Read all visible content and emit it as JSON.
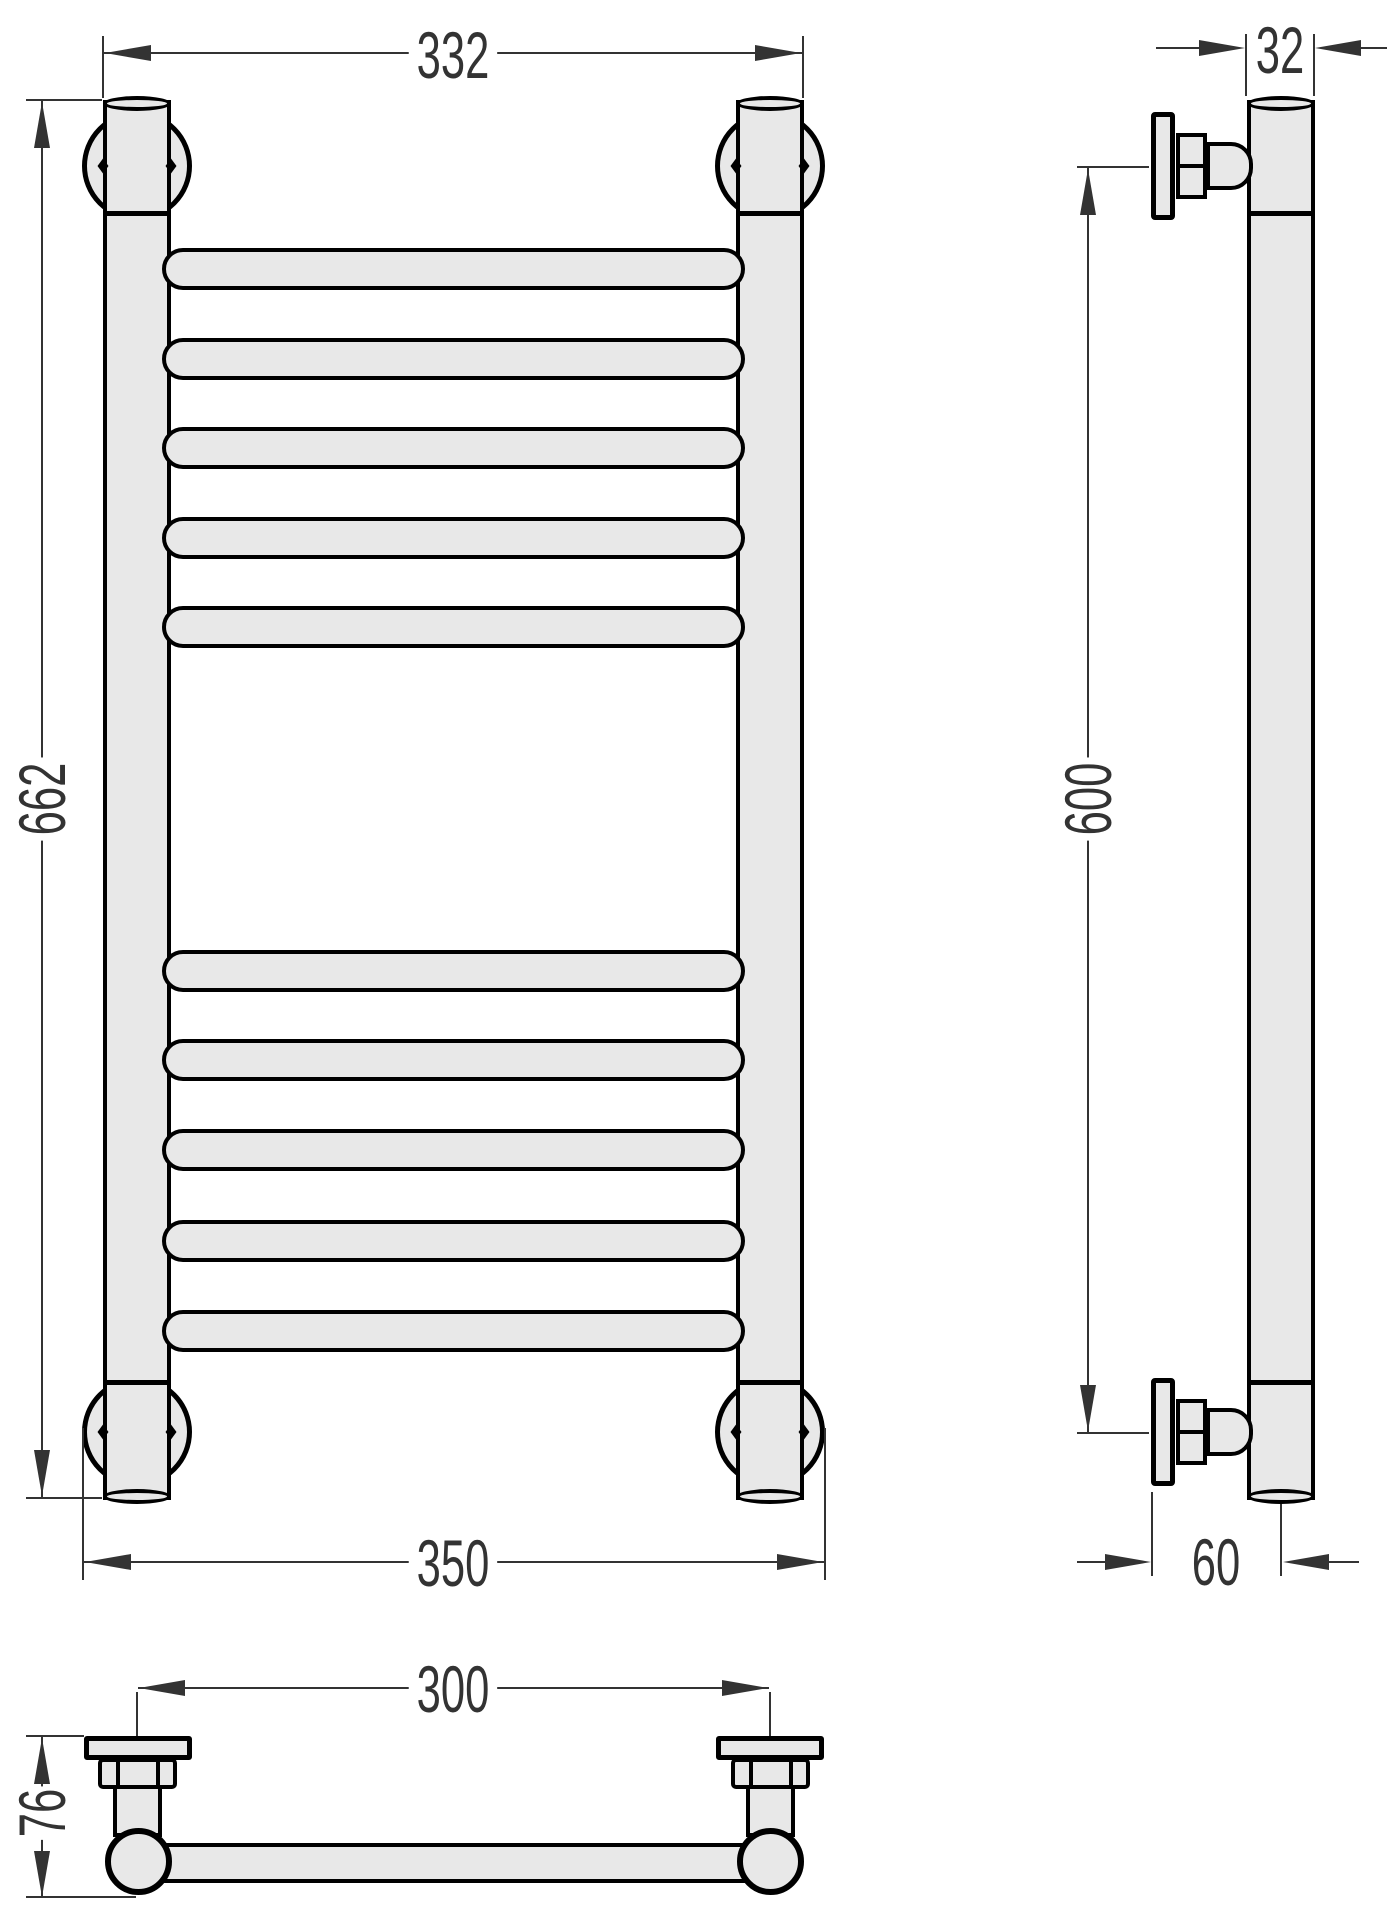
{
  "dims": {
    "front_width": "332",
    "front_height": "662",
    "front_width_bottom": "350",
    "tube_diameter": "32",
    "mount_spacing": "600",
    "wall_offset": "60",
    "mount_spacing_top": "300",
    "depth": "76"
  },
  "colors": {
    "fill": "#e8e8e8",
    "outline": "#000000",
    "dimension": "#333333",
    "background": "#ffffff"
  }
}
